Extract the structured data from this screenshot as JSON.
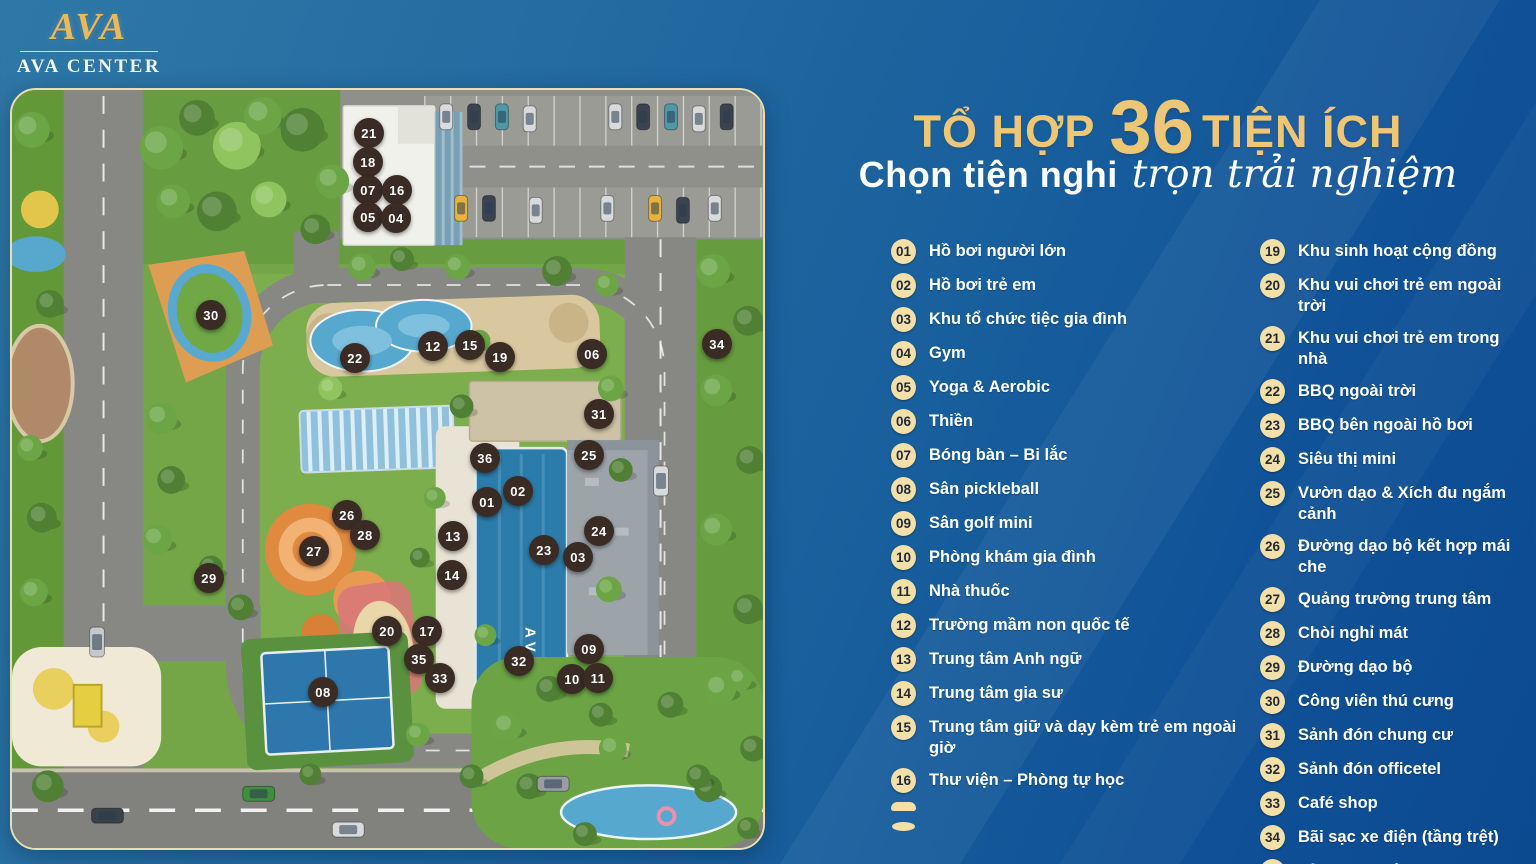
{
  "brand": {
    "monogram": "AVA",
    "name": "AVA CENTER"
  },
  "header": {
    "title_prefix": "TỔ HỢP",
    "title_number": "36",
    "title_suffix": "TIỆN ÍCH",
    "subtitle_bold": "Chọn tiện nghi",
    "subtitle_script": "trọn trải nghiệm"
  },
  "colors": {
    "accent_gold": "#eec776",
    "badge_bg": "#f2e0a8",
    "badge_text": "#222a38",
    "marker_bg": "#3a2c25",
    "list_text": "#ffffff",
    "bg_top_left": "#2e78a7",
    "bg_bottom_right": "#0c4a90"
  },
  "amenities": {
    "left": [
      {
        "num": "01",
        "label": "Hồ bơi người lớn"
      },
      {
        "num": "02",
        "label": "Hồ bơi trẻ em"
      },
      {
        "num": "03",
        "label": "Khu tổ chức tiệc gia đình"
      },
      {
        "num": "04",
        "label": "Gym"
      },
      {
        "num": "05",
        "label": "Yoga & Aerobic"
      },
      {
        "num": "06",
        "label": "Thiền"
      },
      {
        "num": "07",
        "label": "Bóng bàn – Bi lắc"
      },
      {
        "num": "08",
        "label": "Sân pickleball"
      },
      {
        "num": "09",
        "label": "Sân golf mini"
      },
      {
        "num": "10",
        "label": "Phòng khám gia đình"
      },
      {
        "num": "11",
        "label": "Nhà thuốc"
      },
      {
        "num": "12",
        "label": "Trường mầm non quốc tế"
      },
      {
        "num": "13",
        "label": "Trung tâm Anh ngữ"
      },
      {
        "num": "14",
        "label": "Trung tâm gia sư"
      },
      {
        "num": "15",
        "label": "Trung tâm giữ và dạy kèm trẻ em ngoài giờ"
      },
      {
        "num": "16",
        "label": "Thư viện – Phòng tự học"
      },
      {
        "num": "",
        "label": "",
        "partial": true
      }
    ],
    "right": [
      {
        "num": "19",
        "label": "Khu sinh hoạt cộng đồng"
      },
      {
        "num": "20",
        "label": "Khu vui chơi trẻ em ngoài trời"
      },
      {
        "num": "21",
        "label": "Khu vui chơi trẻ em trong nhà"
      },
      {
        "num": "22",
        "label": "BBQ ngoài trời"
      },
      {
        "num": "23",
        "label": "BBQ bên ngoài hồ bơi"
      },
      {
        "num": "24",
        "label": "Siêu thị mini"
      },
      {
        "num": "25",
        "label": "Vườn dạo & Xích đu ngắm cảnh"
      },
      {
        "num": "26",
        "label": "Đường dạo bộ kết hợp mái che"
      },
      {
        "num": "27",
        "label": "Quảng trường trung tâm"
      },
      {
        "num": "28",
        "label": "Chòi nghỉ mát"
      },
      {
        "num": "29",
        "label": "Đường dạo bộ"
      },
      {
        "num": "30",
        "label": "Công viên thú cưng"
      },
      {
        "num": "31",
        "label": "Sảnh đón chung cư"
      },
      {
        "num": "32",
        "label": "Sảnh đón officetel"
      },
      {
        "num": "33",
        "label": "Café shop"
      },
      {
        "num": "34",
        "label": "Bãi sạc xe điện (tầng trệt)"
      },
      {
        "num": "35",
        "label": "Tủ locker thông minh"
      }
    ]
  },
  "map": {
    "pool_label": "AVA",
    "markers": [
      {
        "num": "21",
        "x": 357,
        "y": 43
      },
      {
        "num": "18",
        "x": 356,
        "y": 72
      },
      {
        "num": "07",
        "x": 356,
        "y": 100
      },
      {
        "num": "16",
        "x": 385,
        "y": 100
      },
      {
        "num": "05",
        "x": 356,
        "y": 127
      },
      {
        "num": "04",
        "x": 384,
        "y": 128
      },
      {
        "num": "30",
        "x": 199,
        "y": 225
      },
      {
        "num": "22",
        "x": 343,
        "y": 268
      },
      {
        "num": "12",
        "x": 421,
        "y": 256
      },
      {
        "num": "15",
        "x": 458,
        "y": 255
      },
      {
        "num": "19",
        "x": 488,
        "y": 267
      },
      {
        "num": "06",
        "x": 580,
        "y": 264
      },
      {
        "num": "34",
        "x": 705,
        "y": 254
      },
      {
        "num": "31",
        "x": 587,
        "y": 324
      },
      {
        "num": "25",
        "x": 577,
        "y": 365
      },
      {
        "num": "36",
        "x": 473,
        "y": 368
      },
      {
        "num": "02",
        "x": 506,
        "y": 401
      },
      {
        "num": "01",
        "x": 475,
        "y": 412
      },
      {
        "num": "26",
        "x": 335,
        "y": 425
      },
      {
        "num": "28",
        "x": 353,
        "y": 445
      },
      {
        "num": "27",
        "x": 302,
        "y": 461
      },
      {
        "num": "13",
        "x": 441,
        "y": 446
      },
      {
        "num": "24",
        "x": 587,
        "y": 441
      },
      {
        "num": "23",
        "x": 532,
        "y": 460
      },
      {
        "num": "03",
        "x": 566,
        "y": 467
      },
      {
        "num": "14",
        "x": 440,
        "y": 485
      },
      {
        "num": "29",
        "x": 197,
        "y": 488
      },
      {
        "num": "20",
        "x": 375,
        "y": 541
      },
      {
        "num": "17",
        "x": 415,
        "y": 541
      },
      {
        "num": "35",
        "x": 407,
        "y": 569
      },
      {
        "num": "33",
        "x": 428,
        "y": 588
      },
      {
        "num": "32",
        "x": 507,
        "y": 571
      },
      {
        "num": "09",
        "x": 577,
        "y": 559
      },
      {
        "num": "10",
        "x": 560,
        "y": 589
      },
      {
        "num": "11",
        "x": 586,
        "y": 588
      },
      {
        "num": "08",
        "x": 311,
        "y": 602
      }
    ]
  }
}
